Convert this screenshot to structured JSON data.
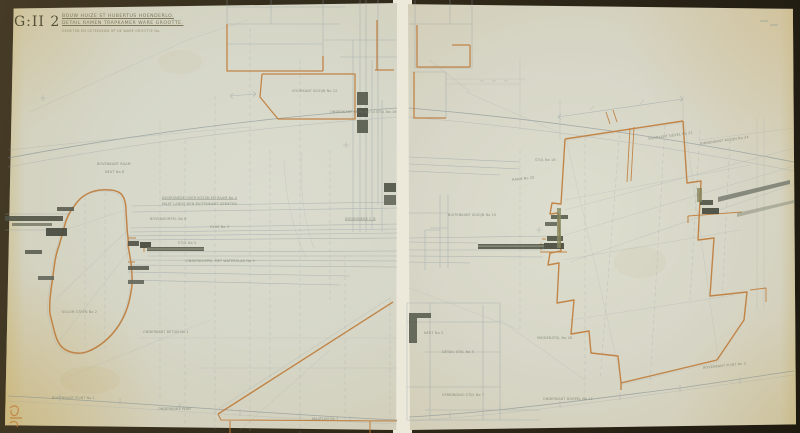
{
  "document": {
    "archive_code": "G:II 2",
    "title_line1": "BOUW HUIZE ST HUBERTUS HOENDERLO.",
    "title_line2": "DETAIL RAMEN TRAPKAMER WARE GROOTTE.",
    "title_line3": "GEMETEN EN GETEEKEND OP DE WARE GROOTTE No.",
    "stamp_mark": "80"
  },
  "colors": {
    "backdrop": "#2e2818",
    "paper": "#d6d7c8",
    "paper_aged_edge": "#cdbb88",
    "gap_backing": "#ece9db",
    "ink_orange": "#bf7c3a",
    "pencil_gray": "#93a0a6",
    "graphite_dark": "#4f5345",
    "olive_green": "#7d8058"
  },
  "annotations": {
    "left": [
      "VOORKANT KOZIJN No 12",
      "ONDERKANT LATEI No 14",
      "STIJL No 16",
      "BOVENKANT RAAM",
      "NEUT No 8",
      "DOORSNEDE OVER KOZIJN EN RAAM No 4",
      "MAAT LANGS DEN BUITENKANT GEMETEN",
      "BOVENDORPEL No 6",
      "GLAS No 3",
      "STIJL No 5",
      "ONDERDORPEL MET WATERSLAG No 9",
      "DOORSNEDE C D",
      "KOLOM STEEN No 2",
      "ONDERKANT BETON No 1",
      "BOVENKANT PLINT No 1",
      "ONDERKANT PLINT",
      "MAATLIJN No 7"
    ],
    "right": [
      "VOORKANT GEVEL No 22",
      "BINNENKANT KOZIJN No 24",
      "STIJL No 18",
      "RAAM No 20",
      "BUITENKANT KOZIJN No 10",
      "MIDDENSTIJL No 28",
      "NEUT No 3",
      "DETAIL STIJL No 5",
      "VERBINDING STIJL No 7",
      "ONDERKANT DORPEL No 11",
      "BOVENKANT PLINT No 2"
    ]
  }
}
